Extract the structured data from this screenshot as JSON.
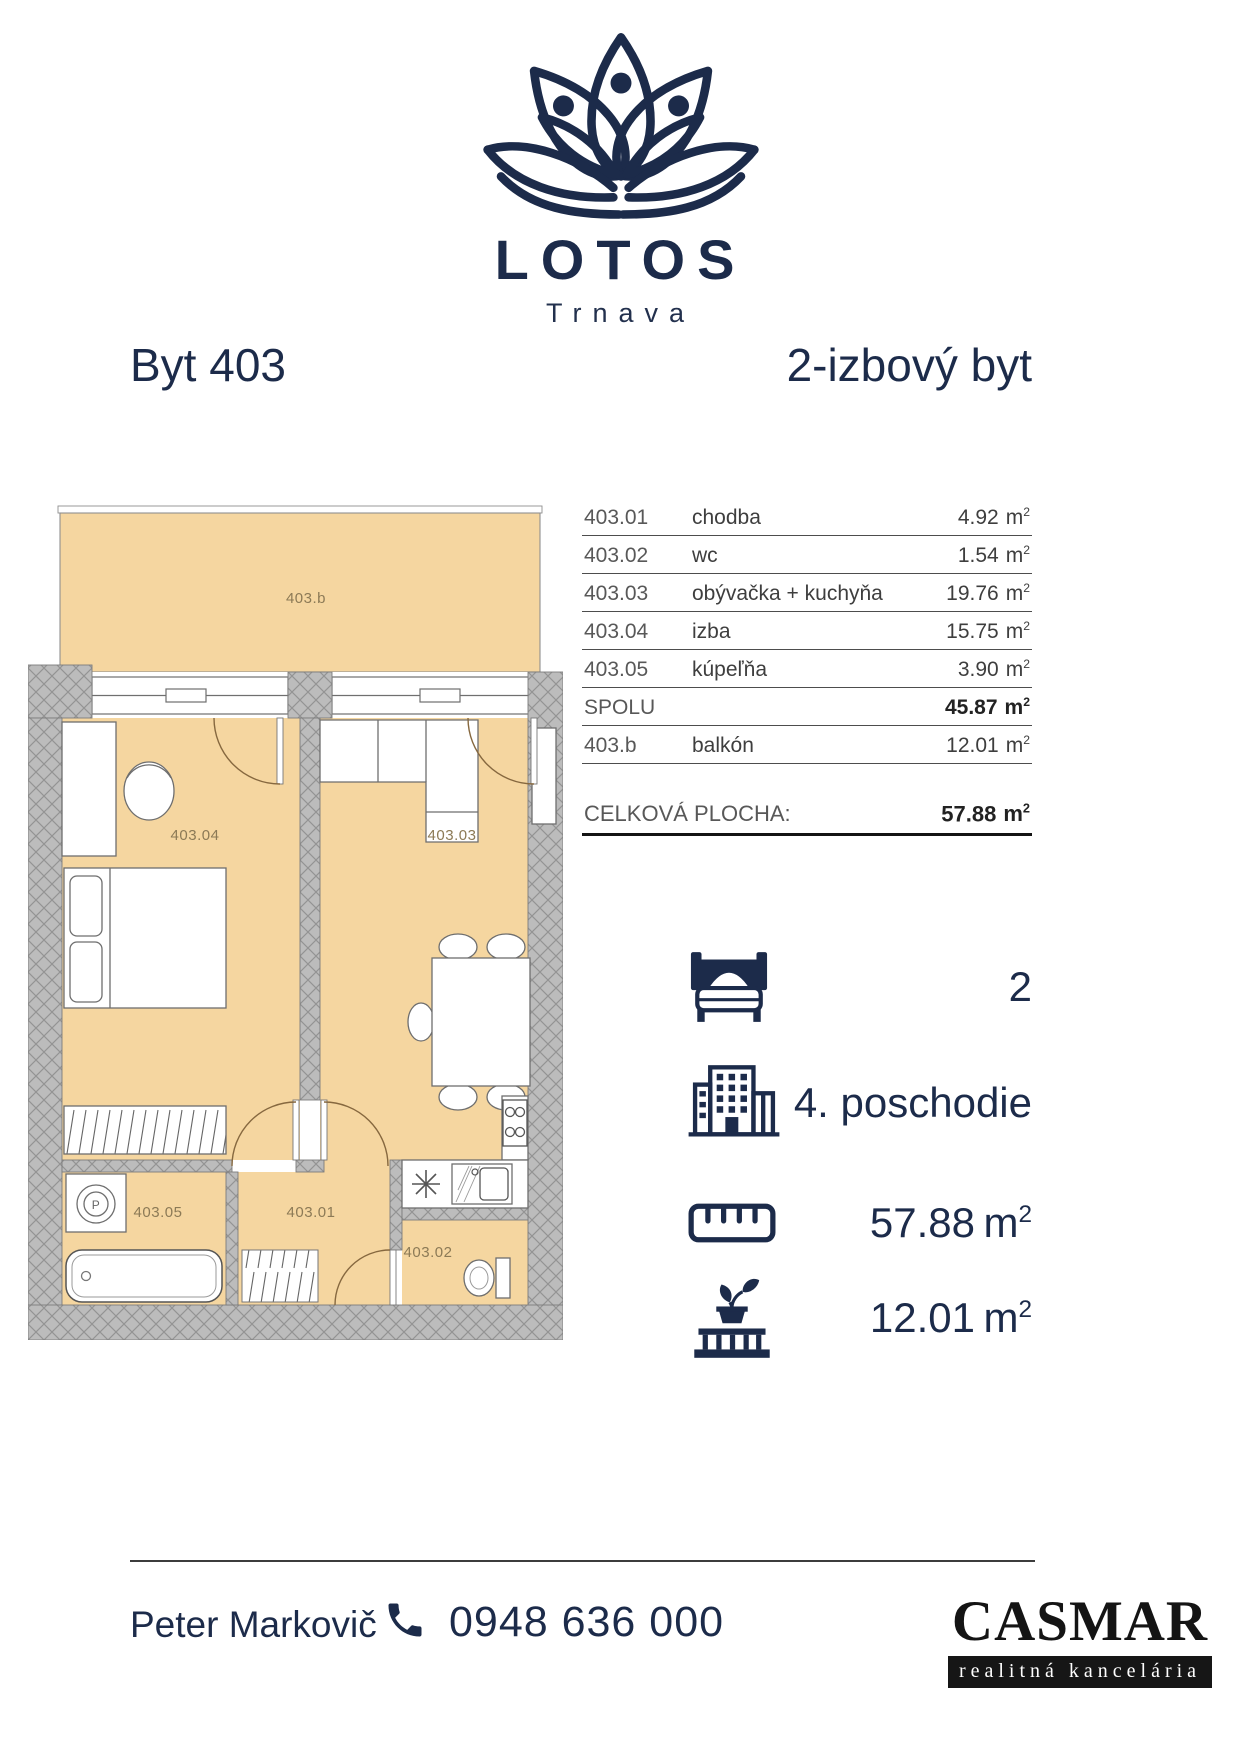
{
  "logo": {
    "name": "LOTOS",
    "city": "Trnava"
  },
  "header": {
    "apartment": "Byt 403",
    "type": "2-izbový byt"
  },
  "units": {
    "m": "m",
    "sup": "2"
  },
  "table": {
    "rows": [
      {
        "id": "403.01",
        "name": "chodba",
        "area": "4.92"
      },
      {
        "id": "403.02",
        "name": "wc",
        "area": "1.54"
      },
      {
        "id": "403.03",
        "name": "obývačka + kuchyňa",
        "area": "19.76"
      },
      {
        "id": "403.04",
        "name": "izba",
        "area": "15.75"
      },
      {
        "id": "403.05",
        "name": "kúpeľňa",
        "area": "3.90"
      }
    ],
    "total_label": "SPOLU",
    "total_area": "45.87",
    "balcony": {
      "id": "403.b",
      "name": "balkón",
      "area": "12.01"
    },
    "grand_total_label": "CELKOVÁ PLOCHA:",
    "grand_total_area": "57.88"
  },
  "features": {
    "rooms": "2",
    "floor": "4. poschodie",
    "area": "57.88",
    "balcony_area": "12.01"
  },
  "plan": {
    "labels": {
      "balcony": "403.b",
      "bedroom": "403.04",
      "living": "403.03",
      "bath": "403.05",
      "hall": "403.01",
      "wc": "403.02",
      "washer": "P"
    },
    "colors": {
      "floor": "#F5D6A0",
      "wall": "#BCBCBC",
      "navy": "#1C2B4A"
    }
  },
  "footer": {
    "agent": "Peter Markovič",
    "phone": "0948 636 000",
    "brand": "CASMAR",
    "brand_sub": "realitná kancelária"
  }
}
